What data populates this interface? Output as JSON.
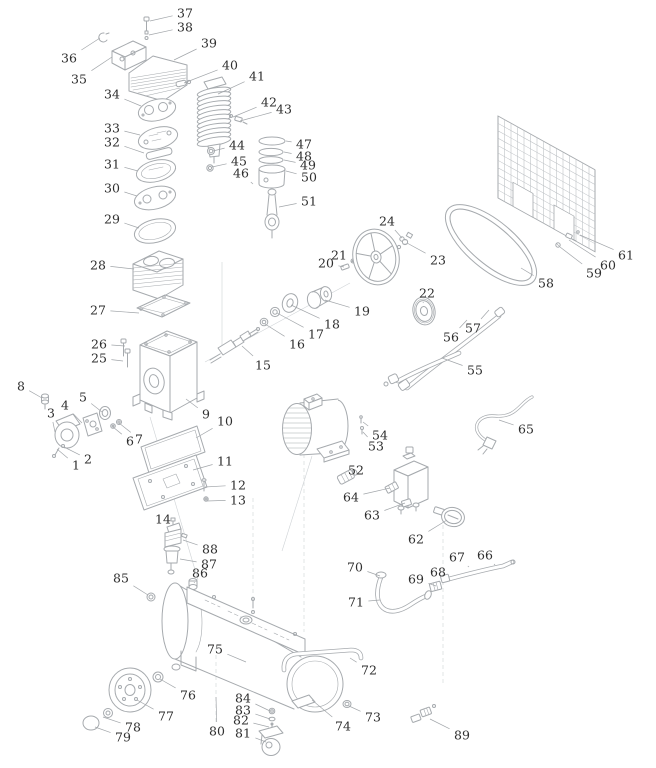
{
  "figure": {
    "type": "exploded-parts-diagram",
    "colors": {
      "background": "#ffffff",
      "line": "#a6aaae",
      "label_text": "#2f2f2f",
      "leader": "#a2a6aa"
    }
  },
  "parts": [
    {
      "n": "1",
      "x": 76,
      "y": 465,
      "tx": 57,
      "ty": 449
    },
    {
      "n": "2",
      "x": 88,
      "y": 459,
      "tx": 64,
      "ty": 447
    },
    {
      "n": "3",
      "x": 51,
      "y": 413,
      "tx": 55,
      "ty": 432
    },
    {
      "n": "4",
      "x": 65,
      "y": 405,
      "tx": 82,
      "ty": 423
    },
    {
      "n": "5",
      "x": 83,
      "y": 397,
      "tx": 102,
      "ty": 412
    },
    {
      "n": "6",
      "x": 130,
      "y": 441,
      "tx": 113,
      "ty": 427
    },
    {
      "n": "7",
      "x": 139,
      "y": 439,
      "tx": 119,
      "ty": 423
    },
    {
      "n": "8",
      "x": 21,
      "y": 386,
      "tx": 42,
      "ty": 398
    },
    {
      "n": "9",
      "x": 206,
      "y": 414,
      "tx": 186,
      "ty": 399
    },
    {
      "n": "10",
      "x": 225,
      "y": 421,
      "tx": 196,
      "ty": 438
    },
    {
      "n": "11",
      "x": 225,
      "y": 461,
      "tx": 193,
      "ty": 470
    },
    {
      "n": "12",
      "x": 238,
      "y": 485,
      "tx": 205,
      "ty": 487
    },
    {
      "n": "13",
      "x": 238,
      "y": 500,
      "tx": 207,
      "ty": 501
    },
    {
      "n": "14",
      "x": 163,
      "y": 519,
      "tx": 172,
      "ty": 528
    },
    {
      "n": "15",
      "x": 263,
      "y": 365,
      "tx": 242,
      "ty": 346
    },
    {
      "n": "16",
      "x": 297,
      "y": 344,
      "tx": 265,
      "ty": 324
    },
    {
      "n": "17",
      "x": 316,
      "y": 334,
      "tx": 277,
      "ty": 313
    },
    {
      "n": "18",
      "x": 332,
      "y": 324,
      "tx": 291,
      "ty": 305
    },
    {
      "n": "19",
      "x": 362,
      "y": 311,
      "tx": 325,
      "ty": 300
    },
    {
      "n": "20",
      "x": 326,
      "y": 263,
      "tx": 344,
      "ty": 267
    },
    {
      "n": "21",
      "x": 339,
      "y": 255,
      "tx": 352,
      "ty": 262
    },
    {
      "n": "22",
      "x": 427,
      "y": 293,
      "tx": 423,
      "ty": 303
    },
    {
      "n": "23",
      "x": 438,
      "y": 260,
      "tx": 407,
      "ty": 243
    },
    {
      "n": "24",
      "x": 387,
      "y": 221,
      "tx": 402,
      "ty": 238
    },
    {
      "n": "25",
      "x": 99,
      "y": 358,
      "tx": 123,
      "ty": 361
    },
    {
      "n": "26",
      "x": 99,
      "y": 344,
      "tx": 125,
      "ty": 346
    },
    {
      "n": "27",
      "x": 98,
      "y": 310,
      "tx": 139,
      "ty": 313
    },
    {
      "n": "28",
      "x": 98,
      "y": 265,
      "tx": 134,
      "ty": 269
    },
    {
      "n": "29",
      "x": 112,
      "y": 219,
      "tx": 139,
      "ty": 228
    },
    {
      "n": "30",
      "x": 112,
      "y": 188,
      "tx": 137,
      "ty": 196
    },
    {
      "n": "31",
      "x": 112,
      "y": 164,
      "tx": 138,
      "ty": 171
    },
    {
      "n": "32",
      "x": 112,
      "y": 142,
      "tx": 144,
      "ty": 153
    },
    {
      "n": "33",
      "x": 112,
      "y": 128,
      "tx": 140,
      "ty": 135
    },
    {
      "n": "34",
      "x": 112,
      "y": 94,
      "tx": 141,
      "ty": 106
    },
    {
      "n": "35",
      "x": 79,
      "y": 79,
      "tx": 112,
      "ty": 57
    },
    {
      "n": "36",
      "x": 69,
      "y": 58,
      "tx": 100,
      "ty": 38
    },
    {
      "n": "37",
      "x": 185,
      "y": 13,
      "tx": 150,
      "ty": 21
    },
    {
      "n": "38",
      "x": 185,
      "y": 27,
      "tx": 149,
      "ty": 35
    },
    {
      "n": "39",
      "x": 209,
      "y": 43,
      "tx": 174,
      "ty": 60
    },
    {
      "n": "40",
      "x": 230,
      "y": 65,
      "tx": 184,
      "ty": 83
    },
    {
      "n": "41",
      "x": 257,
      "y": 76,
      "tx": 218,
      "ty": 94
    },
    {
      "n": "42",
      "x": 269,
      "y": 102,
      "tx": 233,
      "ty": 117
    },
    {
      "n": "43",
      "x": 284,
      "y": 109,
      "tx": 240,
      "ty": 121
    },
    {
      "n": "44",
      "x": 237,
      "y": 145,
      "tx": 213,
      "ty": 151
    },
    {
      "n": "45",
      "x": 239,
      "y": 161,
      "tx": 212,
      "ty": 167
    },
    {
      "n": "46",
      "x": 241,
      "y": 173,
      "tx": 253,
      "ty": 184
    },
    {
      "n": "47",
      "x": 304,
      "y": 144,
      "tx": 286,
      "ty": 141
    },
    {
      "n": "48",
      "x": 304,
      "y": 156,
      "tx": 284,
      "ty": 152
    },
    {
      "n": "49",
      "x": 308,
      "y": 165,
      "tx": 284,
      "ty": 160
    },
    {
      "n": "50",
      "x": 309,
      "y": 177,
      "tx": 286,
      "ty": 171
    },
    {
      "n": "51",
      "x": 309,
      "y": 201,
      "tx": 279,
      "ty": 207
    },
    {
      "n": "52",
      "x": 356,
      "y": 470,
      "tx": 348,
      "ty": 476
    },
    {
      "n": "53",
      "x": 376,
      "y": 446,
      "tx": 363,
      "ty": 432
    },
    {
      "n": "54",
      "x": 380,
      "y": 435,
      "tx": 363,
      "ty": 422
    },
    {
      "n": "55",
      "x": 475,
      "y": 370,
      "tx": 442,
      "ty": 358
    },
    {
      "n": "56",
      "x": 451,
      "y": 337,
      "tx": 467,
      "ty": 320
    },
    {
      "n": "57",
      "x": 473,
      "y": 328,
      "tx": 489,
      "ty": 310
    },
    {
      "n": "58",
      "x": 546,
      "y": 283,
      "tx": 521,
      "ty": 268
    },
    {
      "n": "59",
      "x": 594,
      "y": 273,
      "tx": 560,
      "ty": 247
    },
    {
      "n": "60",
      "x": 608,
      "y": 265,
      "tx": 569,
      "ty": 240
    },
    {
      "n": "61",
      "x": 626,
      "y": 255,
      "tx": 580,
      "ty": 235
    },
    {
      "n": "62",
      "x": 416,
      "y": 539,
      "tx": 447,
      "ty": 520
    },
    {
      "n": "63",
      "x": 372,
      "y": 515,
      "tx": 405,
      "ty": 503
    },
    {
      "n": "64",
      "x": 351,
      "y": 497,
      "tx": 390,
      "ty": 488
    },
    {
      "n": "65",
      "x": 526,
      "y": 429,
      "tx": 499,
      "ty": 420
    },
    {
      "n": "66",
      "x": 485,
      "y": 555,
      "tx": 495,
      "ty": 565
    },
    {
      "n": "67",
      "x": 457,
      "y": 557,
      "tx": 469,
      "ty": 567
    },
    {
      "n": "68",
      "x": 438,
      "y": 572,
      "tx": 447,
      "ty": 579
    },
    {
      "n": "69",
      "x": 416,
      "y": 579,
      "tx": 436,
      "ty": 586
    },
    {
      "n": "70",
      "x": 355,
      "y": 567,
      "tx": 380,
      "ty": 576
    },
    {
      "n": "71",
      "x": 356,
      "y": 602,
      "tx": 380,
      "ty": 600
    },
    {
      "n": "72",
      "x": 369,
      "y": 670,
      "tx": 350,
      "ty": 658
    },
    {
      "n": "73",
      "x": 373,
      "y": 717,
      "tx": 349,
      "ty": 706
    },
    {
      "n": "74",
      "x": 343,
      "y": 726,
      "tx": 312,
      "ty": 700
    },
    {
      "n": "75",
      "x": 215,
      "y": 649,
      "tx": 246,
      "ty": 662
    },
    {
      "n": "76",
      "x": 188,
      "y": 695,
      "tx": 160,
      "ty": 679
    },
    {
      "n": "77",
      "x": 166,
      "y": 716,
      "tx": 137,
      "ty": 700
    },
    {
      "n": "78",
      "x": 133,
      "y": 727,
      "tx": 103,
      "ty": 717
    },
    {
      "n": "79",
      "x": 123,
      "y": 737,
      "tx": 95,
      "ty": 727
    },
    {
      "n": "80",
      "x": 217,
      "y": 731,
      "tx": 216,
      "ty": 697
    },
    {
      "n": "81",
      "x": 243,
      "y": 733,
      "tx": 266,
      "ty": 742
    },
    {
      "n": "82",
      "x": 241,
      "y": 720,
      "tx": 269,
      "ty": 727
    },
    {
      "n": "83",
      "x": 243,
      "y": 710,
      "tx": 270,
      "ty": 719
    },
    {
      "n": "84",
      "x": 243,
      "y": 698,
      "tx": 270,
      "ty": 711
    },
    {
      "n": "85",
      "x": 121,
      "y": 578,
      "tx": 148,
      "ty": 595
    },
    {
      "n": "86",
      "x": 200,
      "y": 573,
      "tx": 194,
      "ty": 583
    },
    {
      "n": "87",
      "x": 209,
      "y": 564,
      "tx": 180,
      "ty": 559
    },
    {
      "n": "88",
      "x": 210,
      "y": 549,
      "tx": 183,
      "ty": 540
    },
    {
      "n": "89",
      "x": 462,
      "y": 735,
      "tx": 430,
      "ty": 719
    }
  ]
}
